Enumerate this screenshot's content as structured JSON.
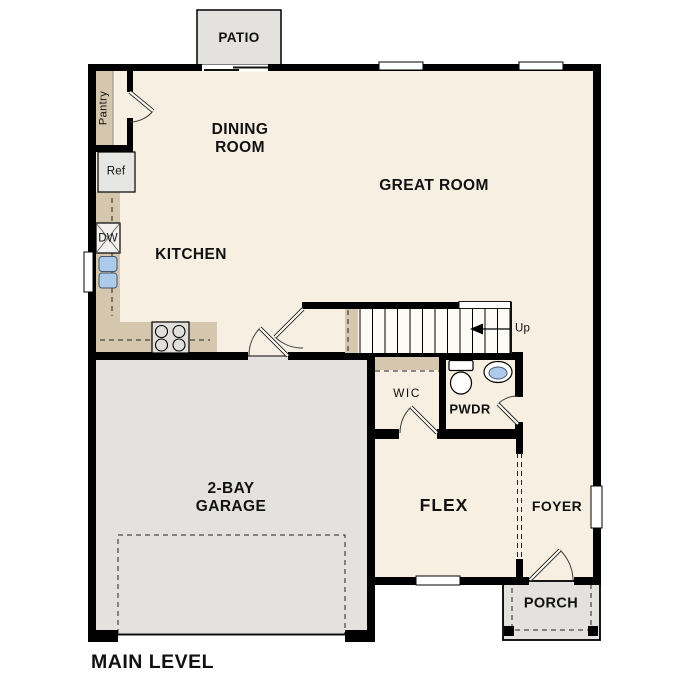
{
  "meta": {
    "level_label": "MAIN LEVEL"
  },
  "rooms": {
    "patio": "PATIO",
    "dining_room_line1": "DINING",
    "dining_room_line2": "ROOM",
    "great_room": "GREAT ROOM",
    "kitchen": "KITCHEN",
    "pantry": "Pantry",
    "wic": "WIC",
    "pwdr": "PWDR",
    "garage_line1": "2-BAY",
    "garage_line2": "GARAGE",
    "flex": "FLEX",
    "foyer": "FOYER",
    "porch": "PORCH"
  },
  "fixtures": {
    "refrigerator": "Ref",
    "dishwasher": "DW",
    "stairs_direction": "Up"
  },
  "colors": {
    "wall": "#000000",
    "floor": "#f7efe2",
    "concrete": "#e3e2de",
    "cabinet": "#d4c7ad",
    "appliance": "#e6e6e4",
    "fixture_blue": "#accbea",
    "background": "#ffffff",
    "text": "#111111"
  }
}
